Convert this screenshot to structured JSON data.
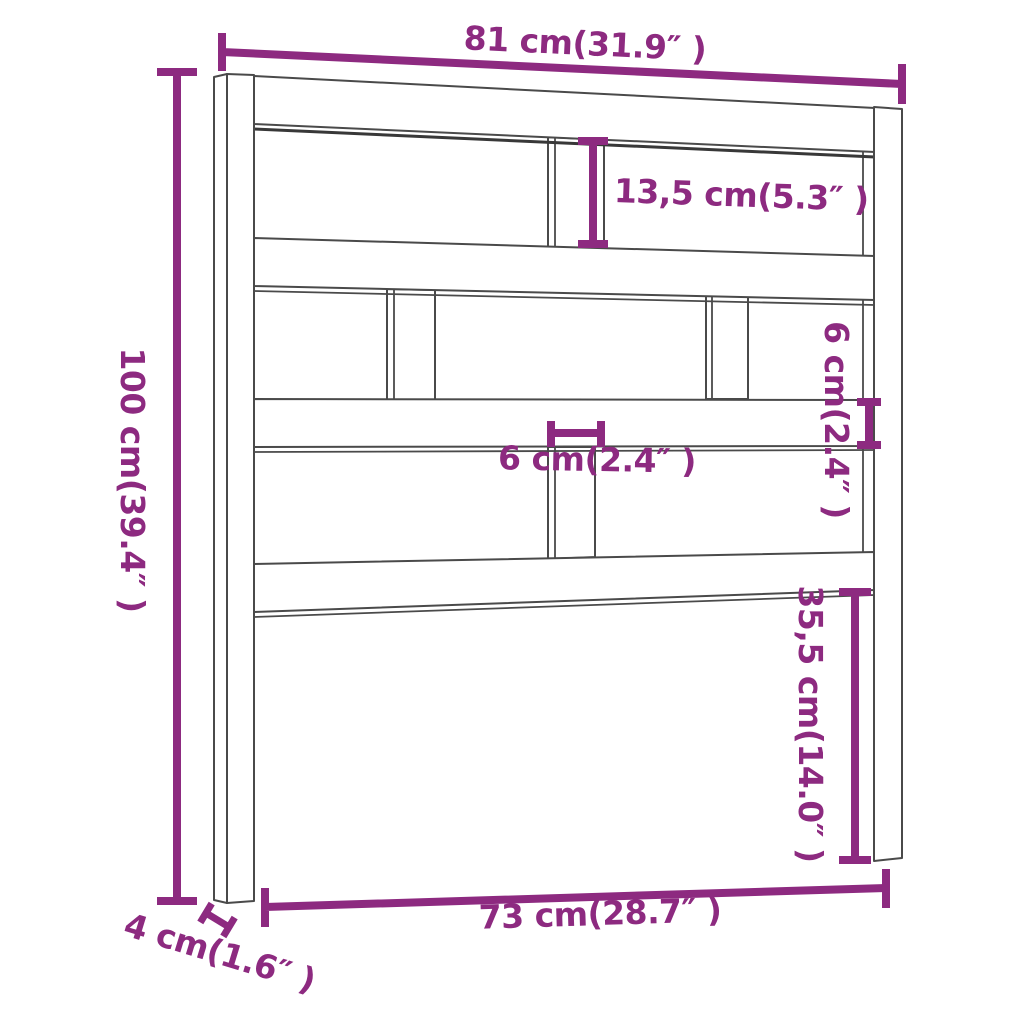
{
  "colors": {
    "accent": "#8D2A80",
    "line": "#4A4A4A",
    "background": "#FFFFFF"
  },
  "diagram": {
    "product": "headboard",
    "dimensions": {
      "top_width": "81 cm(31.9″ )",
      "total_height": "100 cm(39.4″ )",
      "upper_opening_height": "13,5 cm(5.3″ )",
      "rail_thickness": "6 cm(2.4″ )",
      "slat_width": "6 cm(2.4″ )",
      "lower_section_height": "35,5 cm(14.0″ )",
      "inner_width": "73 cm(28.7″ )",
      "post_depth": "4 cm(1.6″ )"
    }
  }
}
